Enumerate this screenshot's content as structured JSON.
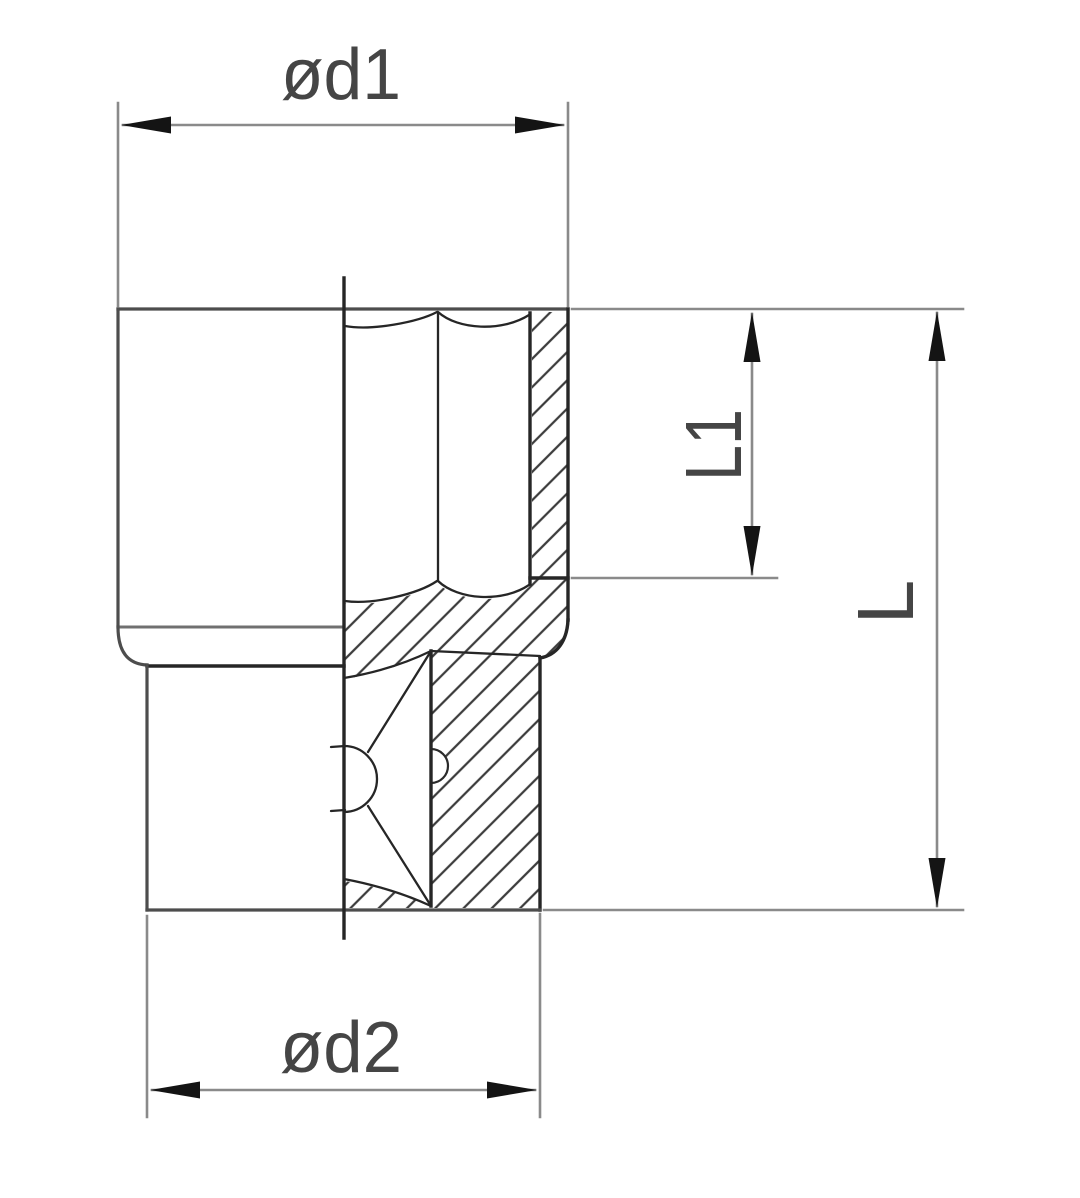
{
  "drawing": {
    "labels": {
      "top_diameter": "ød1",
      "bottom_diameter": "ød2",
      "bore_depth": "L1",
      "total_length": "L"
    }
  },
  "colors": {
    "background": "#ffffff",
    "outline_dark": "#262626",
    "outline_medium": "#4d4d4d",
    "outline_light": "#707070",
    "dimension_line": "#8a8a8a",
    "arrowhead": "#141414",
    "hatch": "#3c3c3c",
    "label_text": "#454545"
  }
}
